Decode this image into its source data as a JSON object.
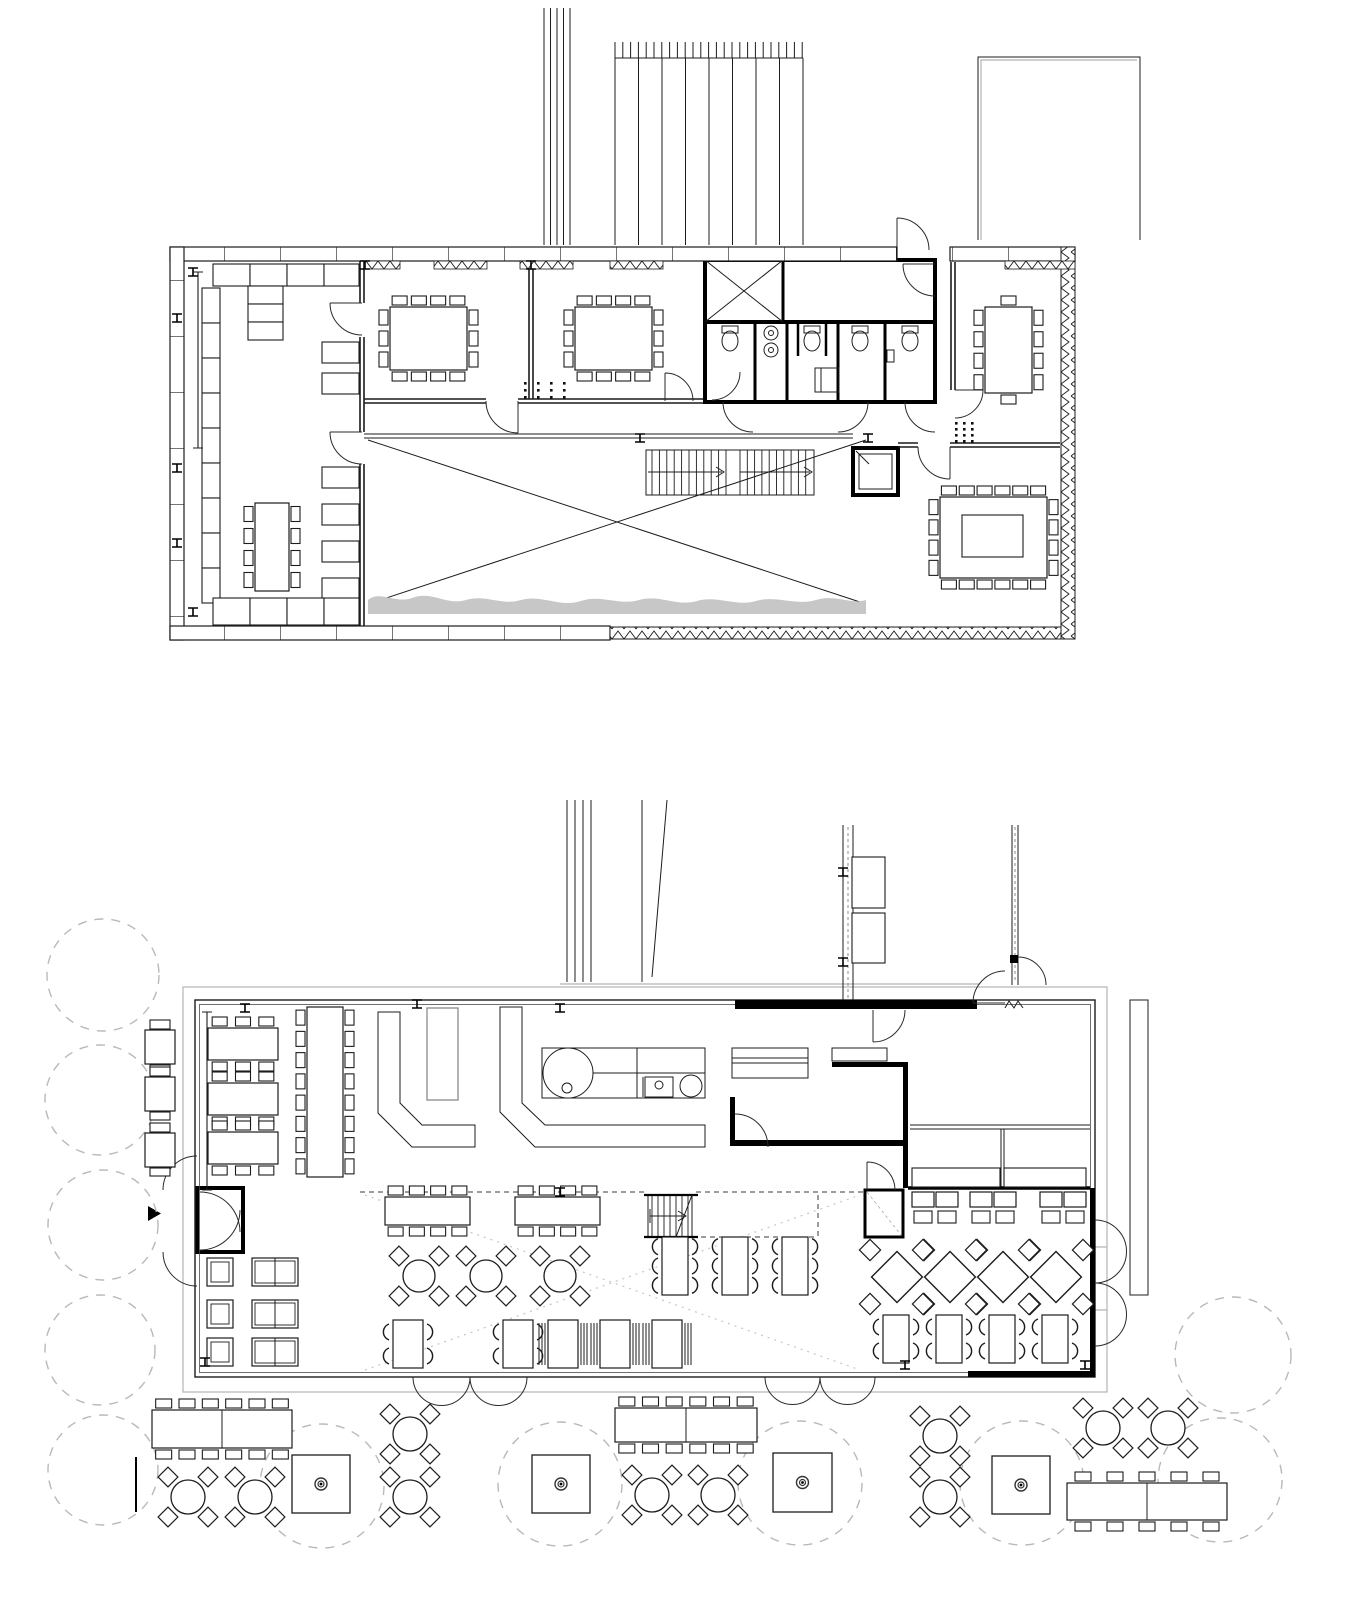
{
  "meta": {
    "title": "Architectural drawing — two floor plans: upper floor with meeting rooms, WC block, stair and void; ground floor restaurant with kitchen, dining areas and outdoor terrace",
    "drawing_type": "floor-plan set",
    "text_labels": []
  },
  "colors": {
    "ink": "#1c1c1c",
    "heavy_wall": "#000000",
    "site_gray": "#b5b5b5",
    "tree_dash": "#b9b9b9",
    "vegetation": "#c7c7c7",
    "paper": "#ffffff"
  },
  "plans": {
    "upper": {
      "label": "upper-floor-plan",
      "furniture": [
        {
          "t": "shelf",
          "x": 213,
          "y": 264,
          "w": 37,
          "h": 22
        },
        {
          "t": "shelf",
          "x": 250,
          "y": 264,
          "w": 37,
          "h": 22
        },
        {
          "t": "shelf",
          "x": 287,
          "y": 264,
          "w": 37,
          "h": 22
        },
        {
          "t": "shelf",
          "x": 324,
          "y": 264,
          "w": 35,
          "h": 22
        },
        {
          "t": "shelf",
          "x": 248,
          "y": 286,
          "w": 35,
          "h": 18
        },
        {
          "t": "shelf",
          "x": 248,
          "y": 304,
          "w": 35,
          "h": 18
        },
        {
          "t": "shelf",
          "x": 248,
          "y": 322,
          "w": 35,
          "h": 18
        },
        {
          "t": "shelf",
          "x": 202,
          "y": 288,
          "w": 18,
          "h": 35
        },
        {
          "t": "shelf",
          "x": 202,
          "y": 323,
          "w": 18,
          "h": 35
        },
        {
          "t": "shelf",
          "x": 202,
          "y": 358,
          "w": 18,
          "h": 35
        },
        {
          "t": "shelf",
          "x": 202,
          "y": 393,
          "w": 18,
          "h": 35
        },
        {
          "t": "shelf",
          "x": 202,
          "y": 428,
          "w": 18,
          "h": 35
        },
        {
          "t": "shelf",
          "x": 202,
          "y": 463,
          "w": 18,
          "h": 35
        },
        {
          "t": "shelf",
          "x": 202,
          "y": 498,
          "w": 18,
          "h": 35
        },
        {
          "t": "shelf",
          "x": 202,
          "y": 533,
          "w": 18,
          "h": 35
        },
        {
          "t": "shelf",
          "x": 202,
          "y": 568,
          "w": 18,
          "h": 35
        },
        {
          "t": "shelf",
          "x": 322,
          "y": 342,
          "w": 37,
          "h": 21
        },
        {
          "t": "shelf",
          "x": 322,
          "y": 373,
          "w": 37,
          "h": 21
        },
        {
          "t": "shelf",
          "x": 322,
          "y": 467,
          "w": 37,
          "h": 21
        },
        {
          "t": "shelf",
          "x": 322,
          "y": 504,
          "w": 37,
          "h": 21
        },
        {
          "t": "shelf",
          "x": 322,
          "y": 541,
          "w": 37,
          "h": 21
        },
        {
          "t": "shelf",
          "x": 322,
          "y": 578,
          "w": 37,
          "h": 21
        },
        {
          "t": "shelf",
          "x": 213,
          "y": 598,
          "w": 37,
          "h": 27
        },
        {
          "t": "shelf",
          "x": 250,
          "y": 598,
          "w": 37,
          "h": 27
        },
        {
          "t": "shelf",
          "x": 287,
          "y": 598,
          "w": 37,
          "h": 27
        },
        {
          "t": "shelf",
          "x": 324,
          "y": 598,
          "w": 35,
          "h": 27
        },
        {
          "t": "table",
          "x": 255,
          "y": 503,
          "w": 34,
          "h": 88,
          "c": [
            0,
            4,
            0,
            4
          ]
        },
        {
          "t": "table",
          "x": 390,
          "y": 307,
          "w": 77,
          "h": 63,
          "c": [
            4,
            3,
            4,
            3
          ]
        },
        {
          "t": "table",
          "x": 575,
          "y": 307,
          "w": 77,
          "h": 63,
          "c": [
            4,
            3,
            4,
            3
          ]
        },
        {
          "t": "table",
          "x": 985,
          "y": 307,
          "w": 47,
          "h": 86,
          "c": [
            1,
            4,
            1,
            4
          ]
        },
        {
          "t": "table",
          "x": 940,
          "y": 497,
          "w": 107,
          "h": 81,
          "c": [
            6,
            4,
            6,
            4
          ],
          "inner": 1
        },
        {
          "t": "dots",
          "x": 524,
          "y": 382,
          "cols": 4,
          "rows": 3,
          "dx": 13,
          "dy": 7
        },
        {
          "t": "dots",
          "x": 955,
          "y": 422,
          "cols": 3,
          "rows": 4,
          "dx": 8,
          "dy": 6
        },
        {
          "t": "bench",
          "x1": 198,
          "y1": 272,
          "x2": 198,
          "y2": 448
        },
        {
          "t": "col",
          "x": 193,
          "y": 272
        },
        {
          "t": "col",
          "x": 193,
          "y": 612
        },
        {
          "t": "col",
          "x": 365,
          "y": 265
        },
        {
          "t": "col",
          "x": 531,
          "y": 265
        },
        {
          "t": "col",
          "x": 640,
          "y": 438
        },
        {
          "t": "col",
          "x": 868,
          "y": 438
        },
        {
          "t": "col",
          "x": 177,
          "y": 318
        },
        {
          "t": "col",
          "x": 177,
          "y": 468
        },
        {
          "t": "col",
          "x": 177,
          "y": 543
        }
      ]
    },
    "lower": {
      "label": "ground-floor-plan",
      "furniture": [
        {
          "t": "tree",
          "cx": 103,
          "cy": 975,
          "r": 56
        },
        {
          "t": "tree",
          "cx": 100,
          "cy": 1100,
          "r": 55
        },
        {
          "t": "tree",
          "cx": 103,
          "cy": 1225,
          "r": 55
        },
        {
          "t": "tree",
          "cx": 100,
          "cy": 1350,
          "r": 55
        },
        {
          "t": "tree",
          "cx": 103,
          "cy": 1470,
          "r": 55
        },
        {
          "t": "tree",
          "cx": 322,
          "cy": 1486,
          "r": 62
        },
        {
          "t": "tree",
          "cx": 560,
          "cy": 1484,
          "r": 62
        },
        {
          "t": "tree",
          "cx": 800,
          "cy": 1483,
          "r": 62
        },
        {
          "t": "tree",
          "cx": 1022,
          "cy": 1483,
          "r": 62
        },
        {
          "t": "tree",
          "cx": 1220,
          "cy": 1480,
          "r": 62
        },
        {
          "t": "tree",
          "cx": 1233,
          "cy": 1355,
          "r": 58
        },
        {
          "t": "table",
          "x": 208,
          "y": 1028,
          "w": 70,
          "h": 32,
          "c": [
            3,
            0,
            3,
            0
          ]
        },
        {
          "t": "table",
          "x": 208,
          "y": 1083,
          "w": 70,
          "h": 32,
          "c": [
            3,
            0,
            3,
            0
          ]
        },
        {
          "t": "table",
          "x": 208,
          "y": 1132,
          "w": 70,
          "h": 32,
          "c": [
            3,
            0,
            3,
            0
          ]
        },
        {
          "t": "table",
          "x": 307,
          "y": 1007,
          "w": 36,
          "h": 170,
          "c": [
            0,
            8,
            0,
            8
          ]
        },
        {
          "t": "table",
          "x": 385,
          "y": 1197,
          "w": 85,
          "h": 28,
          "c": [
            4,
            0,
            4,
            0
          ]
        },
        {
          "t": "table",
          "x": 515,
          "y": 1197,
          "w": 85,
          "h": 28,
          "c": [
            4,
            0,
            4,
            0
          ]
        },
        {
          "t": "round",
          "cx": 419,
          "cy": 1276,
          "r": 16
        },
        {
          "t": "round",
          "cx": 486,
          "cy": 1276,
          "r": 16
        },
        {
          "t": "round",
          "cx": 560,
          "cy": 1276,
          "r": 16
        },
        {
          "t": "vtable",
          "x": 393,
          "y": 1320,
          "w": 30,
          "h": 48,
          "n": 2
        },
        {
          "t": "vtable",
          "x": 503,
          "y": 1320,
          "w": 30,
          "h": 48,
          "n": 2
        },
        {
          "t": "benchtbl",
          "x": 548,
          "y": 1320,
          "w": 30,
          "h": 48
        },
        {
          "t": "benchtbl",
          "x": 600,
          "y": 1320,
          "w": 30,
          "h": 48
        },
        {
          "t": "benchtbl",
          "x": 652,
          "y": 1320,
          "w": 30,
          "h": 48
        },
        {
          "t": "vtable",
          "x": 662,
          "y": 1237,
          "w": 26,
          "h": 58,
          "n": 3
        },
        {
          "t": "vtable",
          "x": 722,
          "y": 1237,
          "w": 26,
          "h": 58,
          "n": 3
        },
        {
          "t": "vtable",
          "x": 782,
          "y": 1237,
          "w": 26,
          "h": 58,
          "n": 3
        },
        {
          "t": "diamond",
          "cx": 897,
          "cy": 1277,
          "s": 36
        },
        {
          "t": "diamond",
          "cx": 950,
          "cy": 1277,
          "s": 36
        },
        {
          "t": "diamond",
          "cx": 1003,
          "cy": 1277,
          "s": 36
        },
        {
          "t": "diamond",
          "cx": 1056,
          "cy": 1277,
          "s": 36
        },
        {
          "t": "vtable",
          "x": 883,
          "y": 1315,
          "w": 26,
          "h": 48,
          "n": 2
        },
        {
          "t": "vtable",
          "x": 936,
          "y": 1315,
          "w": 26,
          "h": 48,
          "n": 2
        },
        {
          "t": "vtable",
          "x": 989,
          "y": 1315,
          "w": 26,
          "h": 48,
          "n": 2
        },
        {
          "t": "vtable",
          "x": 1042,
          "y": 1315,
          "w": 26,
          "h": 48,
          "n": 2
        },
        {
          "t": "shelf",
          "x": 912,
          "y": 1168,
          "w": 88,
          "h": 19
        },
        {
          "t": "shelf",
          "x": 1004,
          "y": 1168,
          "w": 82,
          "h": 19
        },
        {
          "t": "banq",
          "x": 912,
          "y": 1192
        },
        {
          "t": "banq",
          "x": 936,
          "y": 1192
        },
        {
          "t": "banq",
          "x": 970,
          "y": 1192
        },
        {
          "t": "banq",
          "x": 994,
          "y": 1192
        },
        {
          "t": "banq",
          "x": 1040,
          "y": 1192
        },
        {
          "t": "banq",
          "x": 1064,
          "y": 1192
        },
        {
          "t": "armchair",
          "x": 207,
          "y": 1258,
          "w": 26,
          "h": 28
        },
        {
          "t": "armchair",
          "x": 207,
          "y": 1300,
          "w": 26,
          "h": 28
        },
        {
          "t": "armchair",
          "x": 207,
          "y": 1338,
          "w": 26,
          "h": 28
        },
        {
          "t": "sofa",
          "x": 252,
          "y": 1258,
          "w": 46,
          "h": 28
        },
        {
          "t": "sofa",
          "x": 252,
          "y": 1300,
          "w": 46,
          "h": 28
        },
        {
          "t": "sofa",
          "x": 252,
          "y": 1338,
          "w": 46,
          "h": 28
        },
        {
          "t": "smalltable",
          "x": 145,
          "y": 1030
        },
        {
          "t": "smalltable",
          "x": 145,
          "y": 1077
        },
        {
          "t": "smalltable",
          "x": 145,
          "y": 1133
        },
        {
          "t": "longtbl",
          "x": 152,
          "y": 1410,
          "w": 140,
          "h": 38,
          "n": 6
        },
        {
          "t": "longtbl",
          "x": 615,
          "y": 1408,
          "w": 142,
          "h": 34,
          "n": 6
        },
        {
          "t": "longtbl",
          "x": 1067,
          "y": 1483,
          "w": 160,
          "h": 37,
          "n": 5
        },
        {
          "t": "round",
          "cx": 188,
          "cy": 1497,
          "r": 17
        },
        {
          "t": "round",
          "cx": 255,
          "cy": 1497,
          "r": 17
        },
        {
          "t": "round",
          "cx": 410,
          "cy": 1434,
          "r": 17
        },
        {
          "t": "round",
          "cx": 410,
          "cy": 1497,
          "r": 17
        },
        {
          "t": "round",
          "cx": 652,
          "cy": 1495,
          "r": 17
        },
        {
          "t": "round",
          "cx": 718,
          "cy": 1495,
          "r": 17
        },
        {
          "t": "round",
          "cx": 940,
          "cy": 1436,
          "r": 17
        },
        {
          "t": "round",
          "cx": 940,
          "cy": 1497,
          "r": 17
        },
        {
          "t": "round",
          "cx": 1103,
          "cy": 1428,
          "r": 17
        },
        {
          "t": "round",
          "cx": 1168,
          "cy": 1428,
          "r": 17
        },
        {
          "t": "planter",
          "x": 292,
          "y": 1455,
          "s": 58
        },
        {
          "t": "planter",
          "x": 532,
          "y": 1455,
          "s": 58
        },
        {
          "t": "planter",
          "x": 773,
          "y": 1453,
          "s": 59
        },
        {
          "t": "planter",
          "x": 992,
          "y": 1456,
          "s": 58
        },
        {
          "t": "shelf",
          "x": 852,
          "y": 857,
          "w": 33,
          "h": 51
        },
        {
          "t": "shelf",
          "x": 852,
          "y": 913,
          "w": 33,
          "h": 50
        },
        {
          "t": "bench",
          "x1": 207,
          "y1": 1012,
          "x2": 207,
          "y2": 1190
        },
        {
          "t": "line",
          "x1": 136,
          "y1": 1457,
          "x2": 136,
          "y2": 1512
        },
        {
          "t": "col",
          "x": 245,
          "y": 1008
        },
        {
          "t": "col",
          "x": 417,
          "y": 1004
        },
        {
          "t": "col",
          "x": 560,
          "y": 1008
        },
        {
          "t": "col",
          "x": 205,
          "y": 1362
        },
        {
          "t": "col",
          "x": 905,
          "y": 1365
        },
        {
          "t": "col",
          "x": 1085,
          "y": 1365
        },
        {
          "t": "col",
          "x": 560,
          "y": 1192
        },
        {
          "t": "col",
          "x": 843,
          "y": 872
        },
        {
          "t": "col",
          "x": 843,
          "y": 962
        }
      ]
    }
  }
}
